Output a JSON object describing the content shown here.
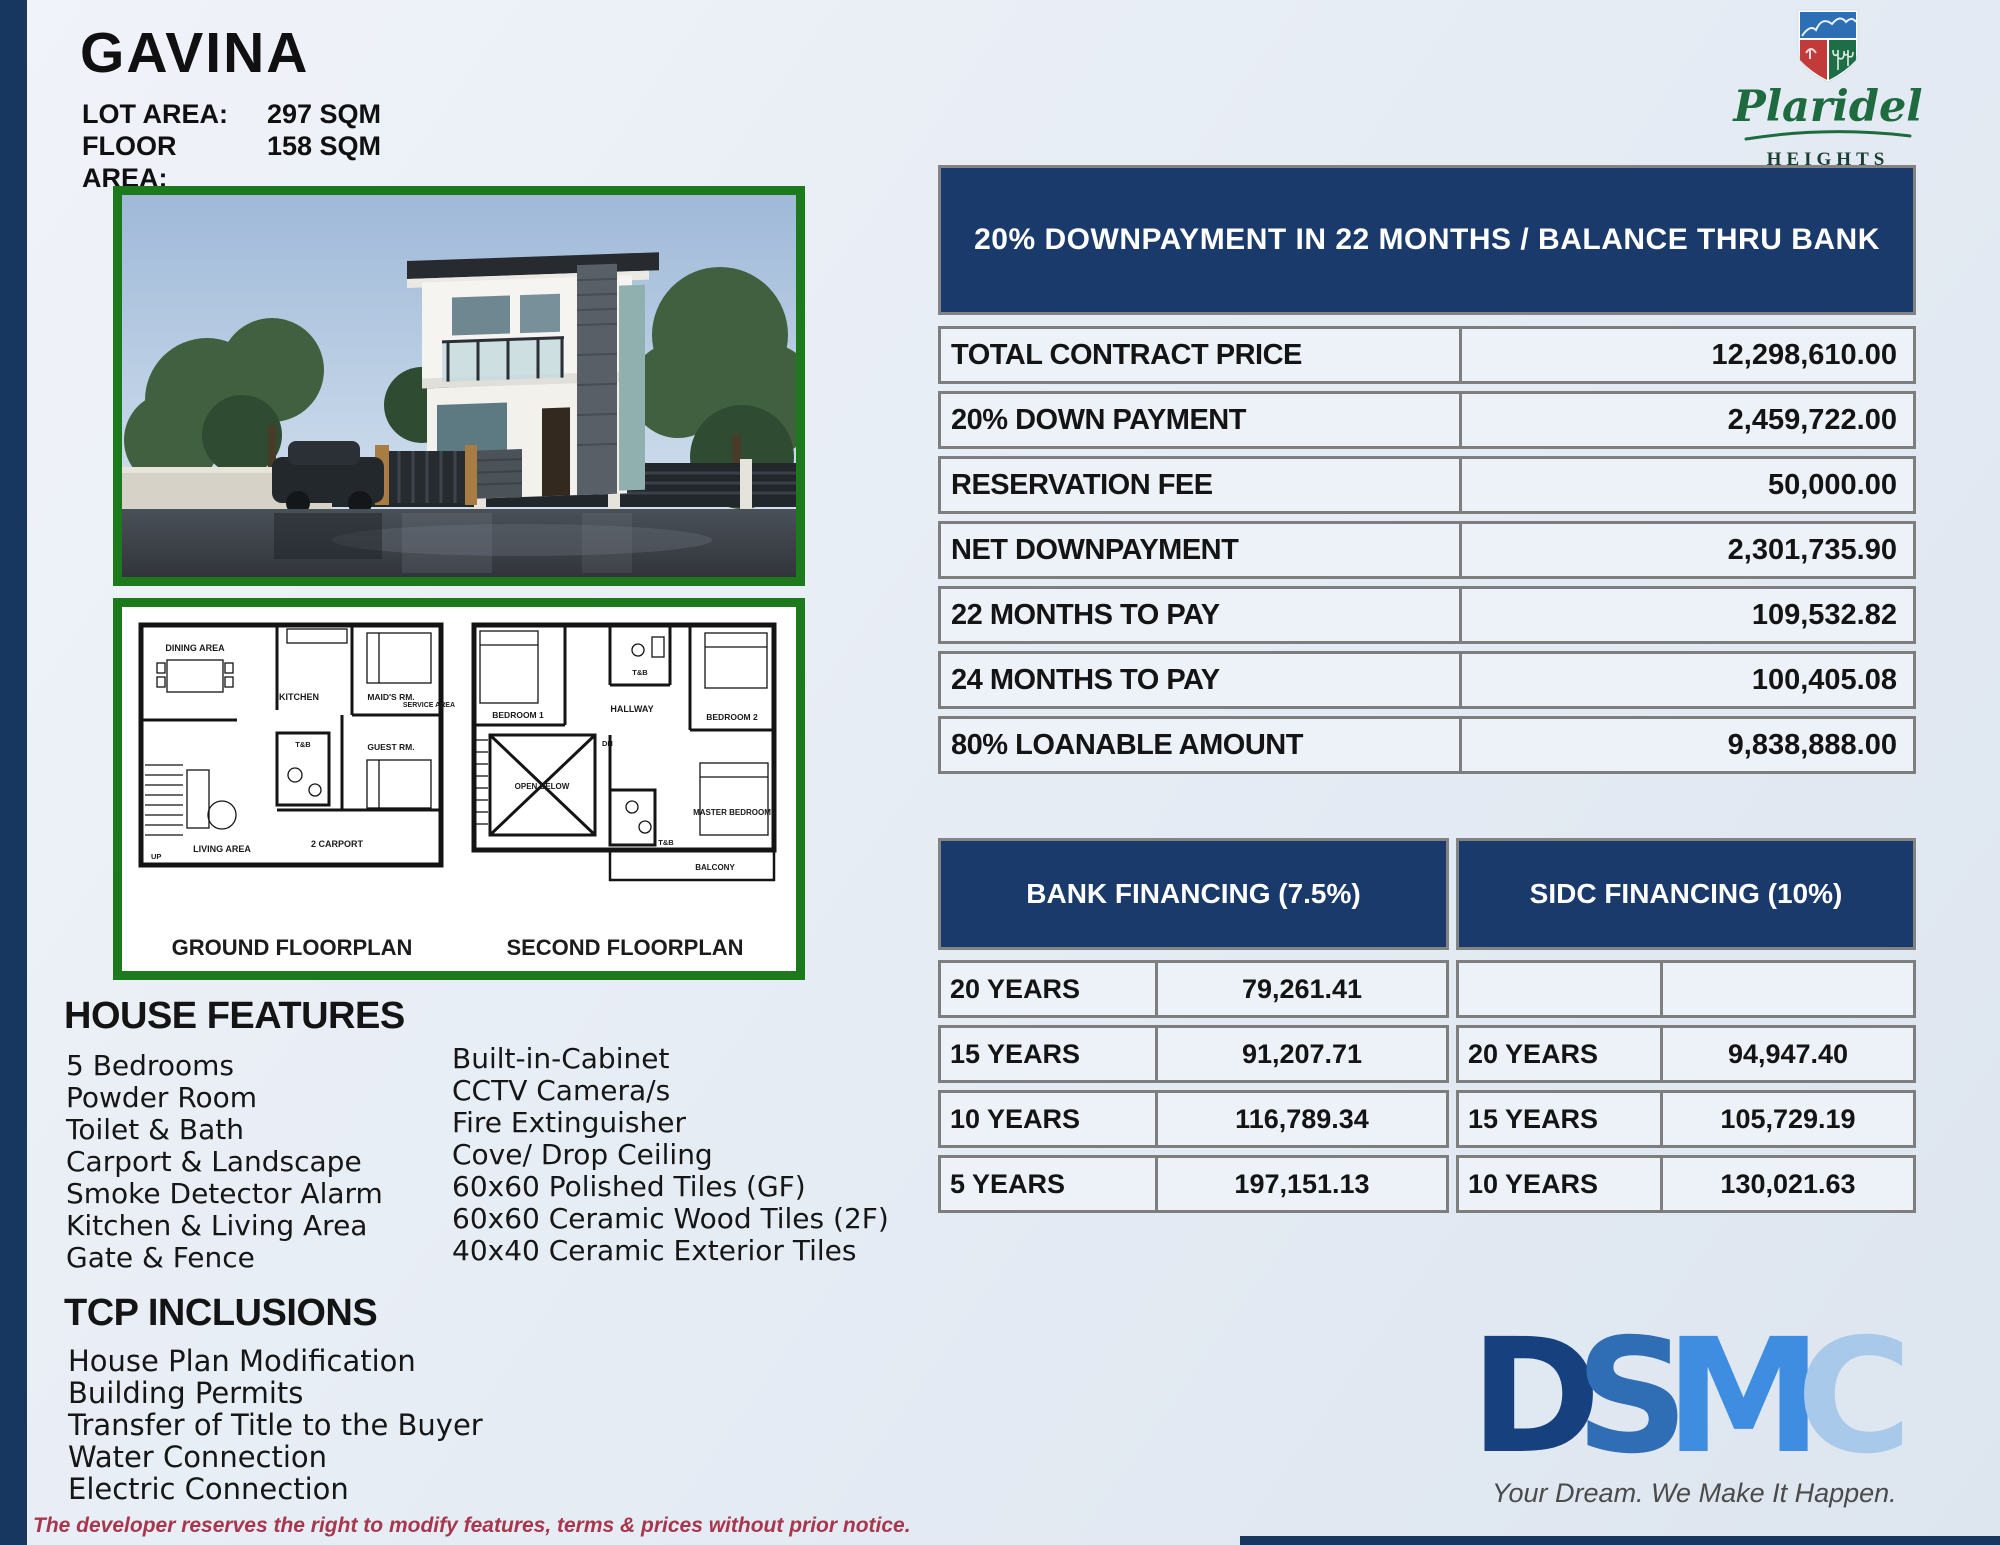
{
  "header": {
    "title": "GAVINA",
    "lot_area_label": "LOT AREA:",
    "lot_area_value": "297 SQM",
    "floor_area_label": "FLOOR AREA:",
    "floor_area_value": "158 SQM"
  },
  "brand": {
    "name_script": "Plaridel",
    "name_sub": "HEIGHTS",
    "name_location": "PLARIDEL, BULACAN"
  },
  "price_table": {
    "header": "20% DOWNPAYMENT IN 22 MONTHS / BALANCE THRU BANK",
    "rows": [
      {
        "label": "TOTAL CONTRACT PRICE",
        "value": "12,298,610.00"
      },
      {
        "label": "20% DOWN PAYMENT",
        "value": "2,459,722.00"
      },
      {
        "label": "RESERVATION FEE",
        "value": "50,000.00"
      },
      {
        "label": "NET DOWNPAYMENT",
        "value": "2,301,735.90"
      },
      {
        "label": "22 MONTHS TO PAY",
        "value": "109,532.82"
      },
      {
        "label": "24 MONTHS TO PAY",
        "value": "100,405.08"
      },
      {
        "label": "80% LOANABLE AMOUNT",
        "value": "9,838,888.00"
      }
    ]
  },
  "financing": {
    "bank": {
      "header": "BANK FINANCING (7.5%)",
      "rows": [
        {
          "term": "20 YEARS",
          "amount": "79,261.41"
        },
        {
          "term": "15 YEARS",
          "amount": "91,207.71"
        },
        {
          "term": "10 YEARS",
          "amount": "116,789.34"
        },
        {
          "term": "5 YEARS",
          "amount": "197,151.13"
        }
      ]
    },
    "sidc": {
      "header": "SIDC FINANCING (10%)",
      "rows": [
        {
          "term": "",
          "amount": ""
        },
        {
          "term": "20 YEARS",
          "amount": "94,947.40"
        },
        {
          "term": "15 YEARS",
          "amount": "105,729.19"
        },
        {
          "term": "10 YEARS",
          "amount": "130,021.63"
        }
      ]
    }
  },
  "house_features": {
    "heading": "HOUSE FEATURES",
    "col1": [
      "5 Bedrooms",
      "Powder Room",
      "Toilet & Bath",
      "Carport & Landscape",
      "Smoke Detector Alarm",
      "Kitchen & Living Area",
      "Gate & Fence"
    ],
    "col2": [
      "Built-in-Cabinet",
      "CCTV Camera/s",
      "Fire Extinguisher",
      "Cove/ Drop Ceiling",
      "60x60 Polished Tiles (GF)",
      "60x60 Ceramic Wood Tiles (2F)",
      "40x40 Ceramic Exterior Tiles"
    ]
  },
  "tcp_inclusions": {
    "heading": "TCP INCLUSIONS",
    "items": [
      "House Plan Modification",
      "Building Permits",
      "Transfer of Title to the Buyer",
      "Water Connection",
      "Electric Connection"
    ]
  },
  "floorplans": {
    "ground": {
      "title": "GROUND FLOORPLAN",
      "labels": [
        "DINING AREA",
        "KITCHEN",
        "MAID'S RM.",
        "SERVICE AREA",
        "GUEST RM.",
        "T&B",
        "LIVING AREA",
        "UP",
        "2 CARPORT"
      ]
    },
    "second": {
      "title": "SECOND FLOORPLAN",
      "labels": [
        "BEDROOM 1",
        "HALLWAY",
        "T&B",
        "BEDROOM 2",
        "DN",
        "OPEN BELOW",
        "T&B",
        "MASTER BEDROOM",
        "BALCONY"
      ]
    }
  },
  "footer": {
    "logo_letters": [
      "D",
      "S",
      "M",
      "C"
    ],
    "tagline": "Your Dream. We Make It Happen.",
    "disclaimer": "The developer reserves the right to modify features, terms & prices without prior notice."
  },
  "colors": {
    "navy": "#1a3a6c",
    "green_frame": "#1c7a1c",
    "dsmc_d": "#16407e",
    "dsmc_s": "#2f6db4",
    "dsmc_m": "#3e8de0",
    "dsmc_c": "#a9c9eb",
    "disclaimer_red": "#a8374e"
  }
}
